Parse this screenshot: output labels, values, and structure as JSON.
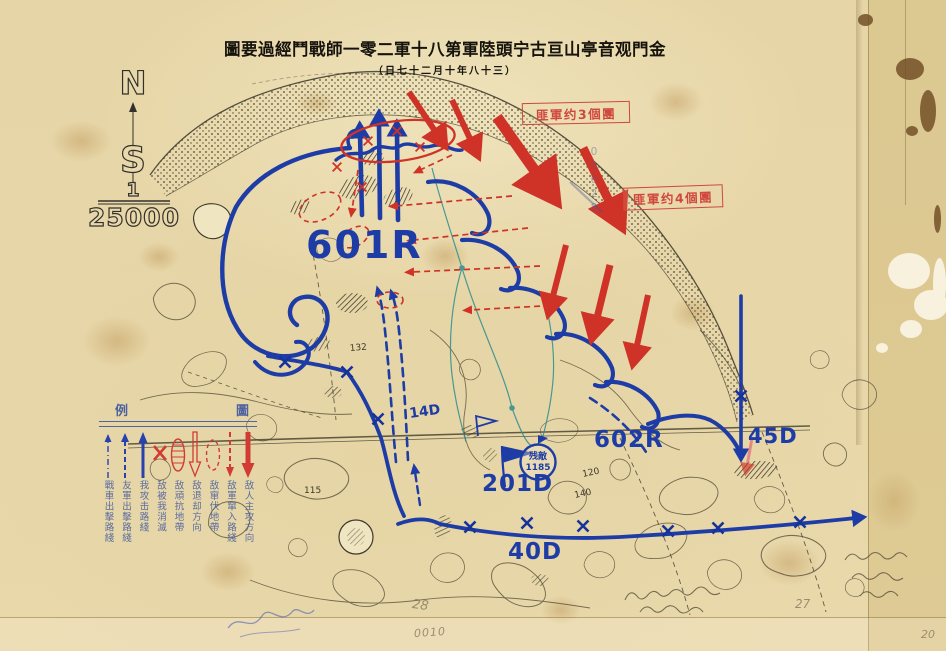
{
  "title": {
    "main": "圖要過經鬥戰師一零二軍十八第軍陸頭宁古亘山亭音观門金",
    "date": "（日七十二月十年八十三）"
  },
  "compass": {
    "north": "N",
    "south": "S",
    "numerator": "1",
    "denominator": "25000"
  },
  "stamps": {
    "enemy_3_regiments": "匪軍约3個團",
    "enemy_4_regiments": "匪軍约4個團"
  },
  "units": {
    "r601": "601R",
    "r602": "602R",
    "d201": "201D",
    "d40": "40D",
    "d45": "45D",
    "d14": "14D"
  },
  "remnant": {
    "line1": "残敵",
    "line2": "1185"
  },
  "terrain": {
    "h132": "132",
    "h115": "115",
    "h120": "120",
    "h140": "140"
  },
  "legend": {
    "header_left": "例",
    "header_right": "圖",
    "items": [
      {
        "label": "敌人主攻方向",
        "symbol": "red-solid-arrow-down"
      },
      {
        "label": "敌軍窜入路綫",
        "symbol": "red-dashed-arrow-down"
      },
      {
        "label": "敌窜伏地帶",
        "symbol": "red-dashed-ellipse"
      },
      {
        "label": "敌退却方向",
        "symbol": "red-hollow-arrow-down"
      },
      {
        "label": "敌頑抗地帶",
        "symbol": "red-hatched-ellipse"
      },
      {
        "label": "敌被我消滅",
        "symbol": "red-x"
      },
      {
        "label": "我攻击路綫",
        "symbol": "blue-solid-arrow-up"
      },
      {
        "label": "友軍出擊路綫",
        "symbol": "blue-dashed-arrow-up"
      },
      {
        "label": "戰車出擊路綫",
        "symbol": "blue-dashdot-arrow-up"
      }
    ]
  },
  "pencil": {
    "p28": "28",
    "p0010": "0010",
    "p27": "27",
    "p20": "20",
    "serial": "00028"
  },
  "colors": {
    "blue_ink": "#1d3ca6",
    "red_ink": "#cf3227",
    "black_ink": "#3b372a",
    "stamp_red": "#d0473e",
    "paper": "#e8d8ab"
  }
}
